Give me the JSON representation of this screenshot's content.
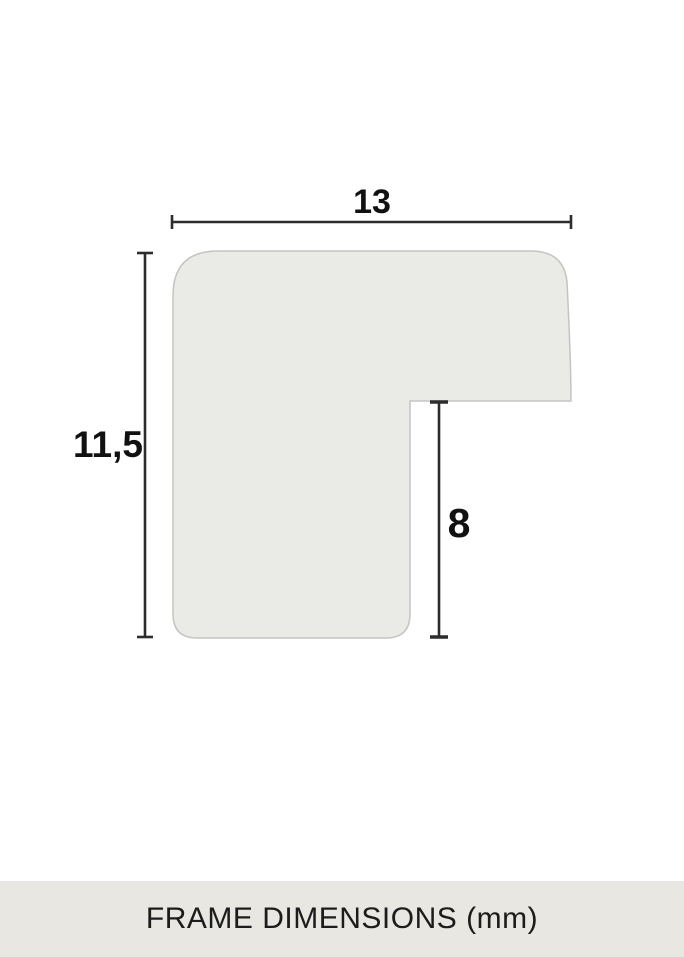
{
  "diagram": {
    "dimensions": {
      "width": {
        "label": "13"
      },
      "height": {
        "label": "11,5"
      },
      "rabbet": {
        "label": "8"
      }
    }
  },
  "footer": {
    "caption": "FRAME DIMENSIONS (mm)"
  },
  "colors": {
    "profile_fill": "#eaeae6",
    "profile_stroke": "#c4c4c0",
    "dimension_line": "#2d2d2d",
    "label_text": "#111111",
    "footer_background": "#e8e7e2",
    "footer_text": "#1c1c1c",
    "page_background": "#ffffff"
  }
}
